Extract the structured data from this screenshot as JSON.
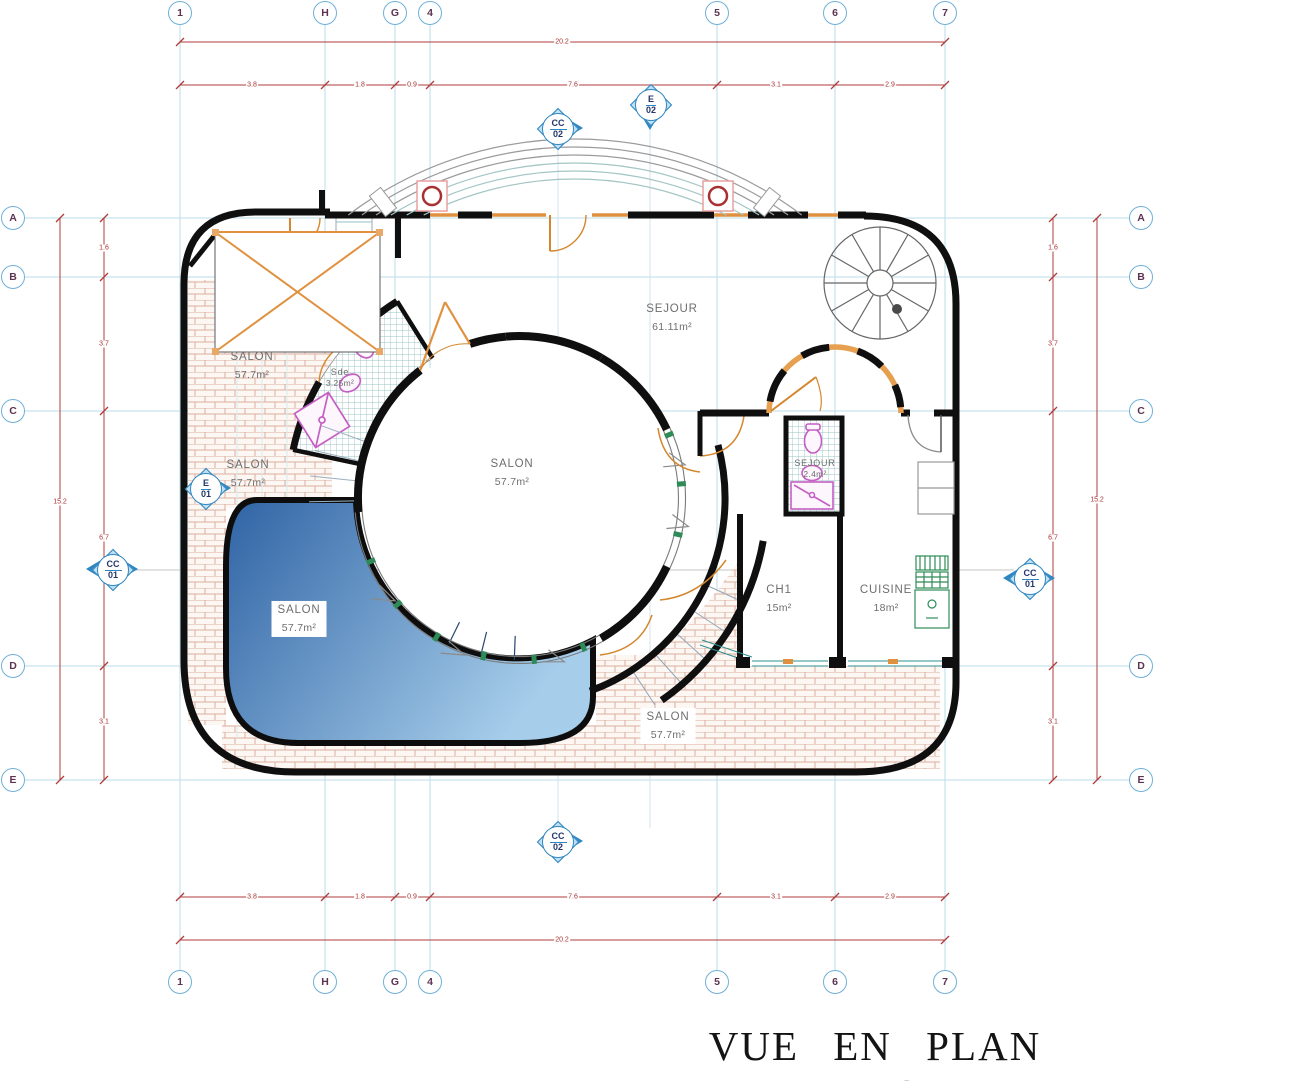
{
  "title": {
    "text": "VUE EN PLAN RDC"
  },
  "grid": {
    "columns": [
      {
        "label": "1"
      },
      {
        "label": "H"
      },
      {
        "label": "G"
      },
      {
        "label": "4"
      },
      {
        "label": "5"
      },
      {
        "label": "6"
      },
      {
        "label": "7"
      }
    ],
    "rows": [
      {
        "label": "A"
      },
      {
        "label": "B"
      },
      {
        "label": "C"
      },
      {
        "label": "D"
      },
      {
        "label": "E"
      }
    ]
  },
  "dimensions": {
    "top": {
      "overall": "20.2",
      "segments": [
        "3.8",
        "1.8",
        "0.9",
        "7.6",
        "3.1",
        "2.9"
      ]
    },
    "bottom": {
      "overall": "20.2",
      "segments": [
        "3.8",
        "1.8",
        "0.9",
        "7.6",
        "3.1",
        "2.9"
      ]
    },
    "left": {
      "overall": "15.2",
      "segments": [
        "1.6",
        "3.7",
        "6.7",
        "3.1"
      ]
    },
    "right": {
      "overall": "15.2",
      "segments": [
        "1.6",
        "3.7",
        "6.7",
        "3.1"
      ]
    }
  },
  "markers": {
    "cc02_top": {
      "code": "CC",
      "num": "02"
    },
    "e02_top": {
      "code": "E",
      "num": "02"
    },
    "e01_left": {
      "code": "E",
      "num": "01"
    },
    "cc01_left": {
      "code": "CC",
      "num": "01"
    },
    "cc01_right": {
      "code": "CC",
      "num": "01"
    },
    "cc02_bottom": {
      "code": "CC",
      "num": "02"
    }
  },
  "rooms": {
    "salon_nw": {
      "name": "SALON",
      "area": "57.7m²"
    },
    "sde": {
      "name": "Sde",
      "area": "3.25m²"
    },
    "sejour_main": {
      "name": "SEJOUR",
      "area": "61.11m²"
    },
    "salon_w": {
      "name": "SALON",
      "area": "57.7m²"
    },
    "salon_center": {
      "name": "SALON",
      "area": "57.7m²"
    },
    "salon_pool": {
      "name": "SALON",
      "area": "57.7m²"
    },
    "sejour_bath": {
      "name": "SEJOUR",
      "area": "2.4m²"
    },
    "ch1": {
      "name": "CH1",
      "area": "15m²"
    },
    "cuisine": {
      "name": "CUISINE",
      "area": "18m²"
    },
    "salon_s": {
      "name": "SALON",
      "area": "57.7m²"
    }
  },
  "colors": {
    "wall": "#0f0f0f",
    "grid_line": "#badbe7",
    "dimension_red": "#b23b3b",
    "marker_blue": "#2e86c1",
    "pool_dark": "#2f63a4",
    "pool_light": "#a6cdea",
    "brick_line": "#dcaf9f",
    "door_orange": "#e0913f",
    "fixture_pink": "#c45fc4",
    "kitchen_green": "#2e8b57",
    "hatch_teal": "#9cc4c4",
    "title_ink": "#141414"
  }
}
